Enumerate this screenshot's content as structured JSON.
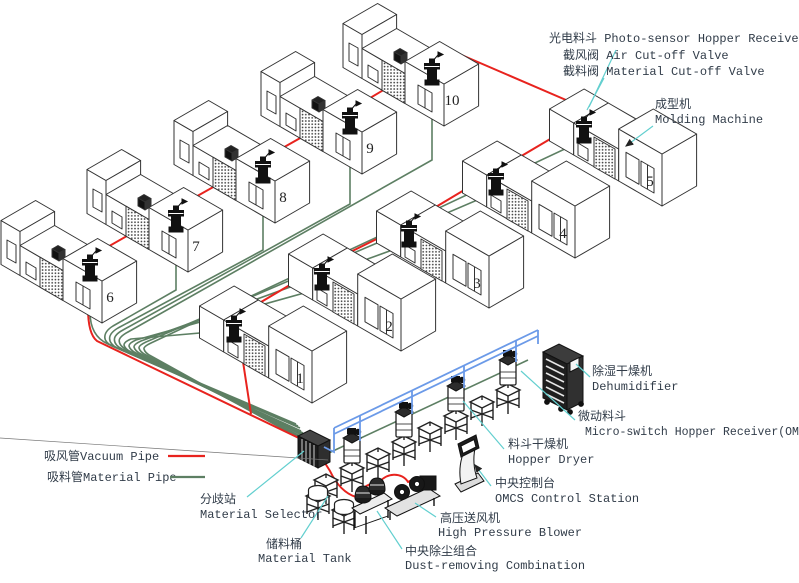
{
  "diagram_title": "Central material conveying system layout",
  "legend": {
    "vacuum": {
      "label": "吸风管Vacuum Pipe"
    },
    "material": {
      "label": "吸料管Material Pipe"
    }
  },
  "colors": {
    "vacuum_pipe": "#e8231e",
    "material_pipe": "#5d7f63",
    "blue_pipe": "#6b9ae8",
    "leader_line": "#62cfcf",
    "outline": "#333333"
  },
  "machines": [
    "1",
    "2",
    "3",
    "4",
    "5",
    "6",
    "7",
    "8",
    "9",
    "10"
  ],
  "labels": {
    "oph": "光电料斗 Photo-sensor Hopper Receiver(OPH)",
    "air_valve": "截风阀 Air Cut-off Valve",
    "material_valve": "截料阀 Material Cut-off Valve",
    "molding_zh": "成型机",
    "molding_en": "Molding Machine",
    "dehumidifier_zh": "除湿干燥机",
    "dehumidifier_en": "Dehumidifier",
    "omh_zh": "微动料斗",
    "omh_en": "Micro-switch Hopper Receiver(OMH)",
    "hopper_dryer_zh": "料斗干燥机",
    "hopper_dryer_en": "Hopper Dryer",
    "control_zh": "中央控制台",
    "control_en": "OMCS Control Station",
    "selector_zh": "分歧站",
    "selector_en": "Material Selector",
    "tank_zh": "储料桶",
    "tank_en": "Material Tank",
    "blower_zh": "高压送风机",
    "blower_en": "High Pressure Blower",
    "dust_zh": "中央除尘组合",
    "dust_en": "Dust-removing Combination"
  }
}
